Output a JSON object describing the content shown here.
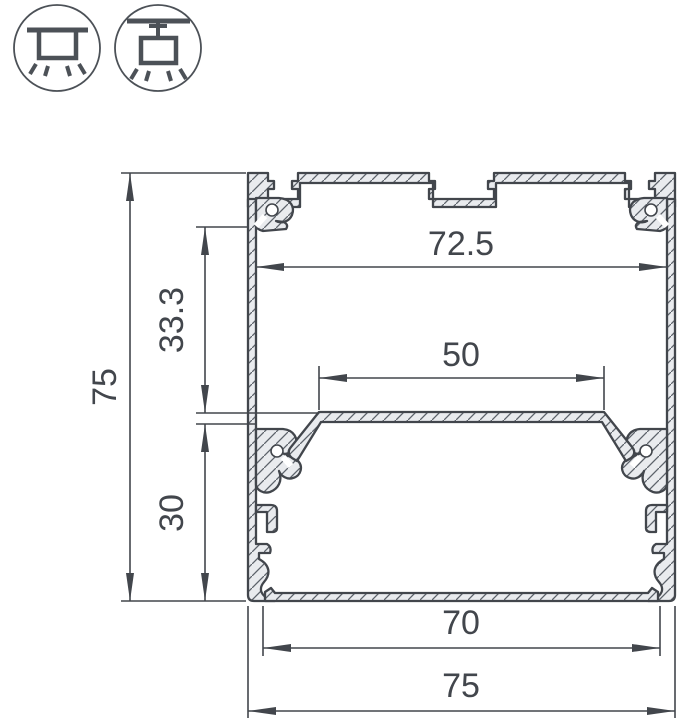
{
  "drawing": {
    "type": "profile-cross-section",
    "dimensions": {
      "overall_height": "75",
      "upper_inner_depth": "33.3",
      "lower_inner_depth": "30",
      "inner_top_width": "72.5",
      "led_plate_width": "50",
      "inner_bottom_width": "70",
      "overall_width": "75"
    }
  },
  "icons": [
    {
      "name": "surface-mounted-luminaire-icon"
    },
    {
      "name": "suspended-luminaire-icon"
    }
  ],
  "colors": {
    "line": "#42464c",
    "metal_fill": "#e9ebee",
    "hatch": "#5c626a",
    "background": "#ffffff",
    "icon_line": "#4c5157",
    "dim_text": "#42464c"
  }
}
